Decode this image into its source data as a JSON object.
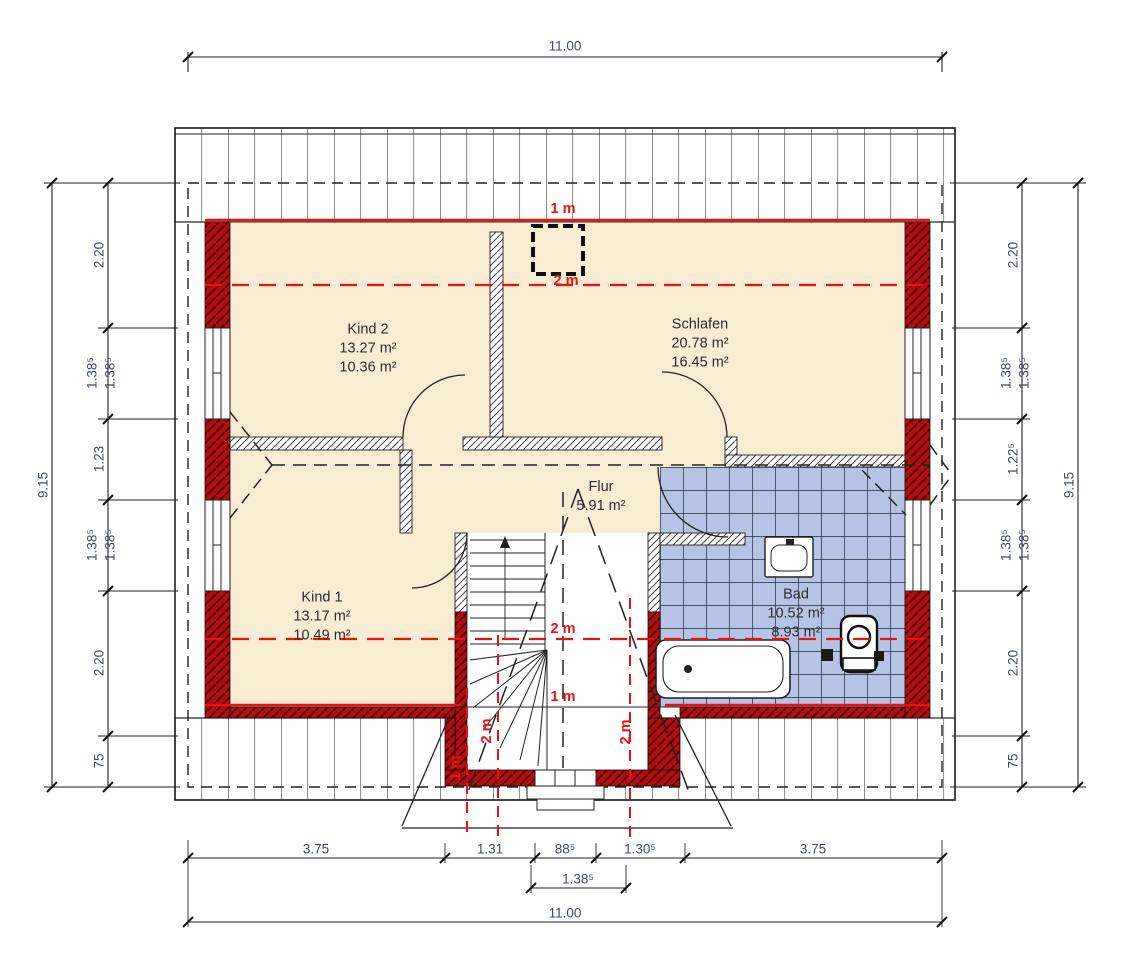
{
  "drawing": {
    "type": "floor-plan",
    "floor": "Dachgeschoss"
  },
  "rooms": {
    "kind2": {
      "name": "Kind 2",
      "area1": "13.27 m²",
      "area2": "10.36 m²"
    },
    "schlafen": {
      "name": "Schlafen",
      "area1": "20.78 m²",
      "area2": "16.45 m²"
    },
    "kind1": {
      "name": "Kind 1",
      "area1": "13.17 m²",
      "area2": "10.49 m²"
    },
    "flur": {
      "name": "Flur",
      "area1": "5.91 m²"
    },
    "bad": {
      "name": "Bad",
      "area1": "10.52 m²",
      "area2": "8.93 m²"
    }
  },
  "dimensions": {
    "top": {
      "total": "11.00"
    },
    "bottom": {
      "segments": [
        "3.75",
        "1.31",
        "88⁵",
        "1.30⁵",
        "3.75"
      ],
      "window": "1.38⁵",
      "total": "11.00"
    },
    "left": {
      "segments": [
        "2.20",
        "1.38⁵",
        "1.38⁵",
        "1.23",
        "1.38⁵",
        "1.38⁵",
        "2.20",
        "75"
      ],
      "total": "9.15"
    },
    "right": {
      "segments": [
        "2.20",
        "1.38⁵",
        "1.38⁵",
        "1.22⁵",
        "1.38⁵",
        "1.38⁵",
        "2.20",
        "75"
      ],
      "total": "9.15"
    }
  },
  "height_lines": {
    "one_m": "1 m",
    "two_m": "2 m"
  },
  "colors": {
    "room_fill": "#f8ecd2",
    "tile_fill": "#b5c4e4",
    "wall_masonry": "#b30e0e",
    "height_line_red": "#ea1111",
    "dim_text": "#3f4b63",
    "line_black": "#222222"
  }
}
